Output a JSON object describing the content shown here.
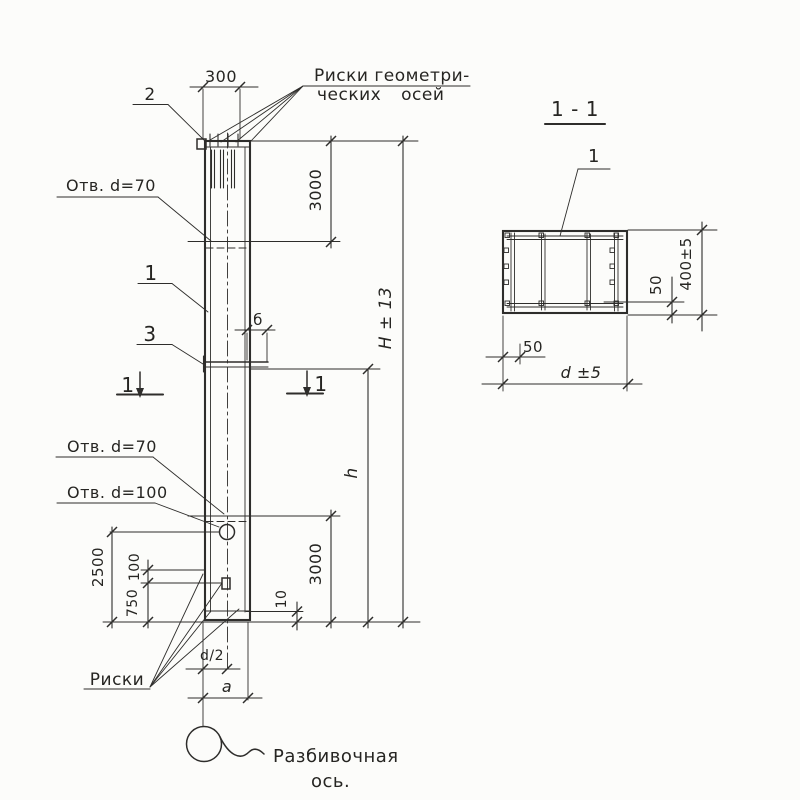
{
  "colors": {
    "ink": "#2e2d2b",
    "paper": "#fcfcfa"
  },
  "elevation": {
    "callouts": {
      "item1": "1",
      "item2": "2",
      "item3": "3",
      "axis_marks_line1": "Риски геометри-",
      "axis_marks_line2": "ческих осей",
      "hole_top": "Отв. d=70",
      "hole_mid": "Отв. d=70",
      "hole_big": "Отв. d=100",
      "bottom_marks": "Риски",
      "layout_axis_line1": "Разбивочная",
      "layout_axis_line2": "ось."
    },
    "section_cut": {
      "left": "1",
      "right": "1"
    },
    "dims": {
      "top_width": "300",
      "upper_span": "3000",
      "lower_span": "3000",
      "total_height": "H ± 13",
      "lower_height": "h",
      "ledge_offset": "б",
      "hole_from_bottom": "2500",
      "plate_gap": "100",
      "mark_from_bottom": "750",
      "end_gap": "10",
      "half_width": "d/2",
      "axis_to_edge": "a"
    }
  },
  "section": {
    "title": "1 - 1",
    "callout_item1": "1",
    "dims": {
      "height": "400±5",
      "cover_right": "50",
      "cover_left": "50",
      "width": "d ±5"
    }
  }
}
